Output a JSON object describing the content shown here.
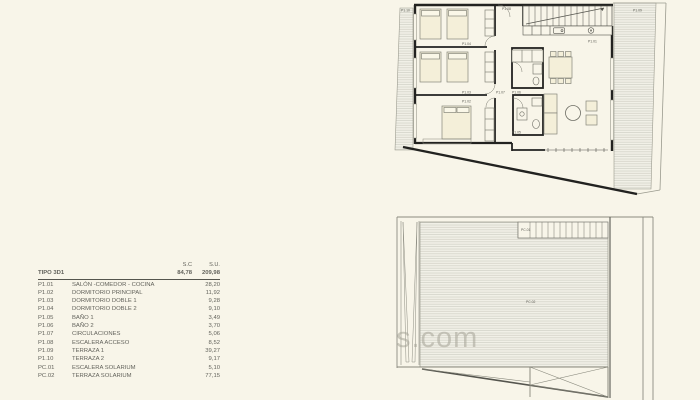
{
  "page": {
    "background_color": "#f8f5e9",
    "wall_color": "#222220",
    "hatch_line_color": "#ccccc0",
    "furniture_fill": "#f4efd9",
    "text_color": "#63635c"
  },
  "watermark": {
    "text": "s.com"
  },
  "table": {
    "col_headers": {
      "sc": "S.C",
      "su": "S.U."
    },
    "total_row": {
      "code": "TIPO 3D1",
      "sc": "84,78",
      "su": "209,98"
    },
    "rows": [
      {
        "code": "P1.01",
        "name": "SALÓN -COMEDOR - COCINA",
        "su": "28,20"
      },
      {
        "code": "P1.02",
        "name": "DORMITORIO PRINCIPAL",
        "su": "11,92"
      },
      {
        "code": "P1.03",
        "name": "DORMITORIO DOBLE 1",
        "su": "9,28"
      },
      {
        "code": "P1.04",
        "name": "DORMITORIO DOBLE 2",
        "su": "9,10"
      },
      {
        "code": "P1.05",
        "name": "BAÑO 1",
        "su": "3,49"
      },
      {
        "code": "P1.06",
        "name": "BAÑO 2",
        "su": "3,70"
      },
      {
        "code": "P1.07",
        "name": "CIRCULACIONES",
        "su": "5,06"
      },
      {
        "code": "P1.08",
        "name": "ESCALERA ACCESO",
        "su": "8,52"
      },
      {
        "code": "P1.09",
        "name": "TERRAZA 1",
        "su": "39,27"
      },
      {
        "code": "P1.10",
        "name": "TERRAZA 2",
        "su": "9,17"
      },
      {
        "code": "PC.01",
        "name": "ESCALERA SOLARIUM",
        "su": "5,10"
      },
      {
        "code": "PC.02",
        "name": "TERRAZA SOLARIUM",
        "su": "77,15"
      }
    ]
  },
  "plan_floor": {
    "labels": {
      "p101": "P1.01",
      "p102": "P1.02",
      "p103": "P1.03",
      "p104": "P1.04",
      "p105": "P1.05",
      "p106": "P1.06",
      "p107": "P1.07",
      "p108": "P1.08",
      "p109": "P1.09",
      "p110": "P1.10"
    }
  },
  "plan_solarium": {
    "labels": {
      "pc01": "PC.01",
      "pc02": "PC.02"
    }
  }
}
